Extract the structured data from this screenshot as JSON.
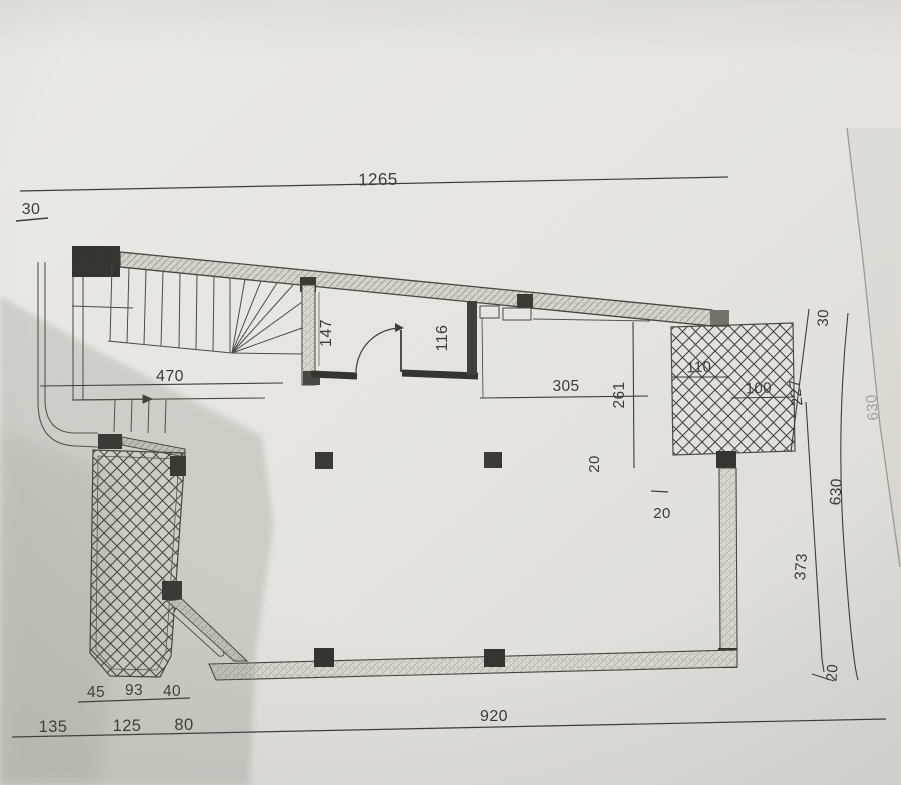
{
  "labels": {
    "top_overall": "1265",
    "top_wall": "30",
    "stair_width": "470",
    "room_a": "147",
    "room_b": "116",
    "hall_width": "305",
    "hall_depth": "261",
    "col_note_a": "20",
    "col_note_b": "20",
    "terrace_a": "110",
    "terrace_b": "100",
    "right_wall_top": "30",
    "right_upper": "227",
    "right_total": "630",
    "right_outer": "630",
    "right_lower": "373",
    "right_bottom": "20",
    "bottom_inner_1": "45",
    "bottom_inner_2": "93",
    "bottom_inner_3": "40",
    "bottom_outer_1": "135",
    "bottom_outer_2": "125",
    "bottom_outer_3": "80",
    "bottom_overall": "920"
  },
  "colors": {
    "paper": "#e9e6e1",
    "ink": "#3d3c38",
    "wall_fill": "#d8d4cc",
    "column": "#35332e",
    "shadow": "#51604d"
  }
}
